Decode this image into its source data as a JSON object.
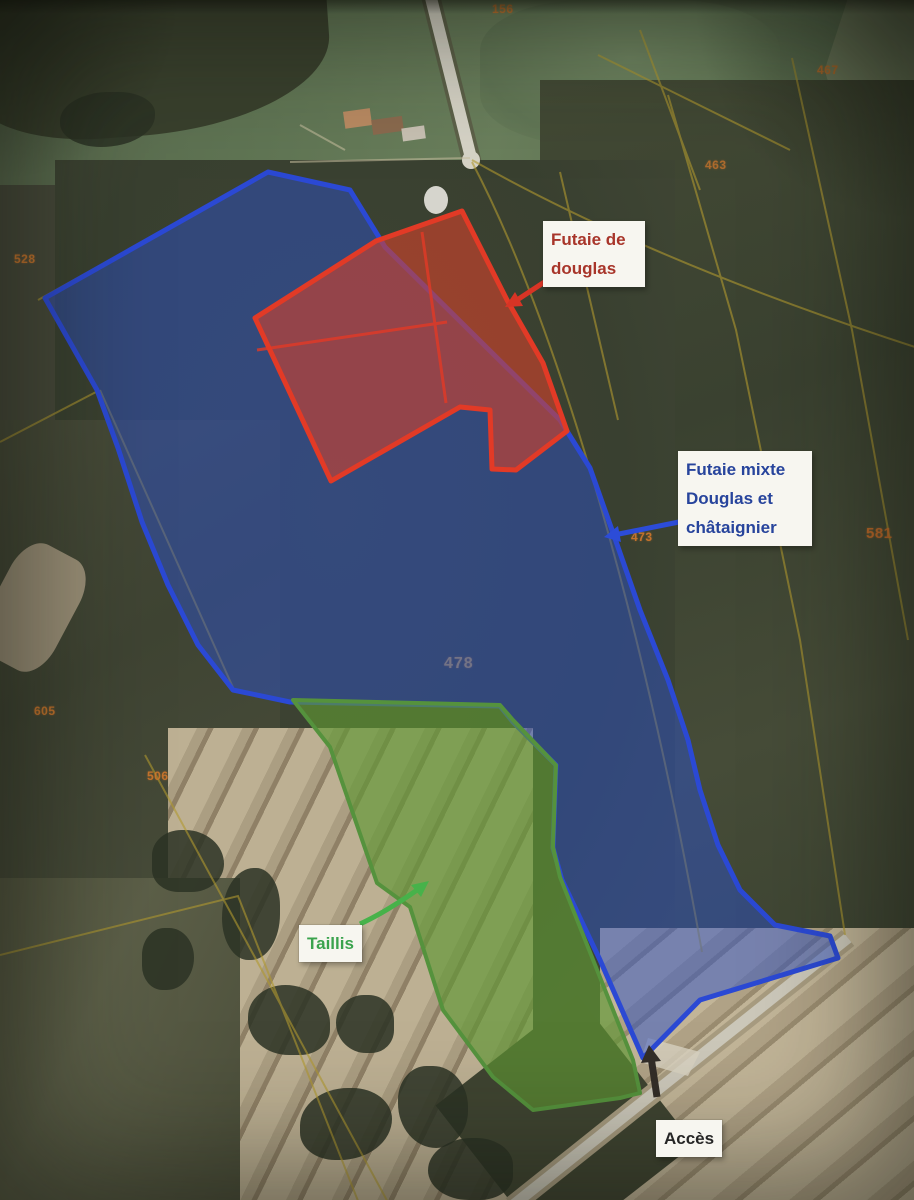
{
  "map_title": "Plan de peuplements forestiers sur photo aérienne",
  "annotations": {
    "futaie_douglas": {
      "lines": [
        "Futaie de",
        "douglas"
      ],
      "text_color": "#a8352a",
      "arrow_color": "#d83425"
    },
    "futaie_mixte": {
      "lines": [
        "Futaie mixte",
        "Douglas et",
        "châtaignier"
      ],
      "text_color": "#27449c",
      "arrow_color": "#2c4cd8"
    },
    "taillis": {
      "lines": [
        "Taillis"
      ],
      "text_color": "#3aa34d",
      "arrow_color": "#47b24a"
    },
    "acces": {
      "lines": [
        "Accès"
      ],
      "text_color": "#262626",
      "arrow_color": "#332e28"
    }
  },
  "zones": {
    "futaie_douglas": {
      "name": "Futaie de douglas",
      "fill": "rgba(208,66,44,0.62)",
      "stroke": "#e23a26"
    },
    "futaie_mixte": {
      "name": "Futaie mixte Douglas et châtaignier",
      "fill": "rgba(44,80,196,0.5)",
      "stroke": "#2b49d4"
    },
    "taillis": {
      "name": "Taillis",
      "fill": "rgba(96,150,52,0.66)",
      "stroke": "#55923d"
    }
  },
  "parcels": [
    {
      "value": "156"
    },
    {
      "value": "467"
    },
    {
      "value": "463"
    },
    {
      "value": "528"
    },
    {
      "value": "605"
    },
    {
      "value": "506"
    },
    {
      "value": "473"
    },
    {
      "value": "581"
    },
    {
      "value": "478"
    }
  ],
  "parcel_number_color": "#d2782c"
}
